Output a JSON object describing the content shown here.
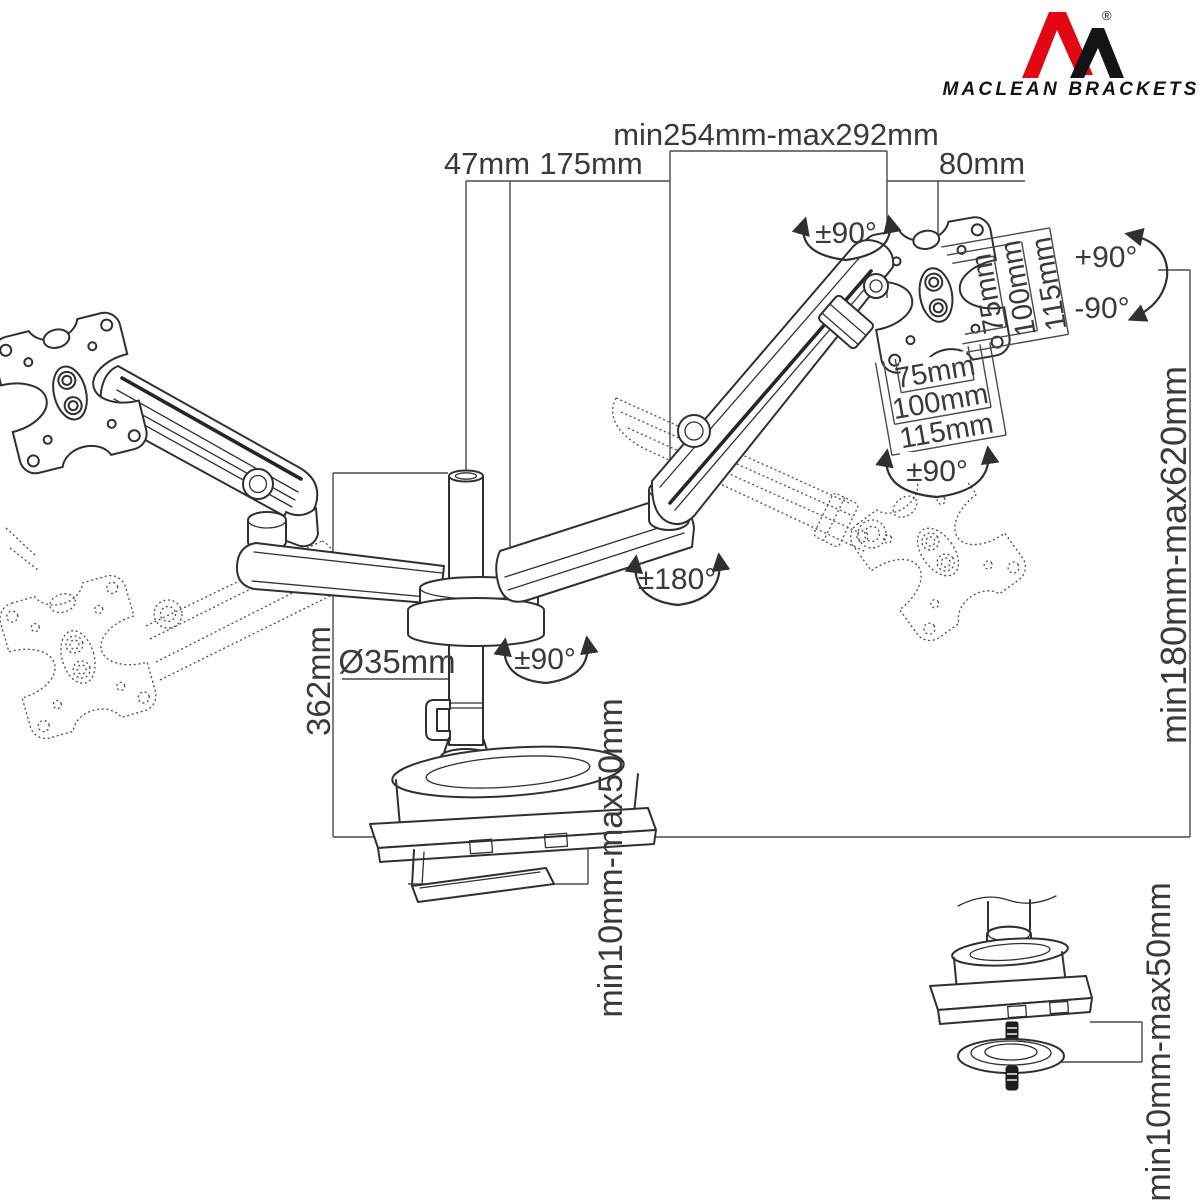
{
  "brand": {
    "name": "MACLEAN BRACKETS",
    "registered": "®",
    "logo_red": "#e30613",
    "logo_black": "#141414"
  },
  "labels": {
    "pole_offset": "47mm",
    "lower_arm_length": "175mm",
    "upper_arm_range": "min254mm-max292mm",
    "vesa_offset": "80mm",
    "head_swivel": "±90°",
    "tilt_up": "+90°",
    "tilt_down": "-90°",
    "vesa_vertical": [
      "75mm",
      "100mm",
      "115mm"
    ],
    "vesa_horizontal": [
      "75mm",
      "100mm",
      "115mm"
    ],
    "screen_rotation": "±90°",
    "arm_swivel": "±180°",
    "pole_swivel": "±90°",
    "pole_diameter": "Ø35mm",
    "pole_height": "362mm",
    "height_range": "min180mm-max620mm",
    "desk_thickness": "min10mm-max50mm",
    "desk_thickness_detail": "min10mm-max50mm"
  }
}
